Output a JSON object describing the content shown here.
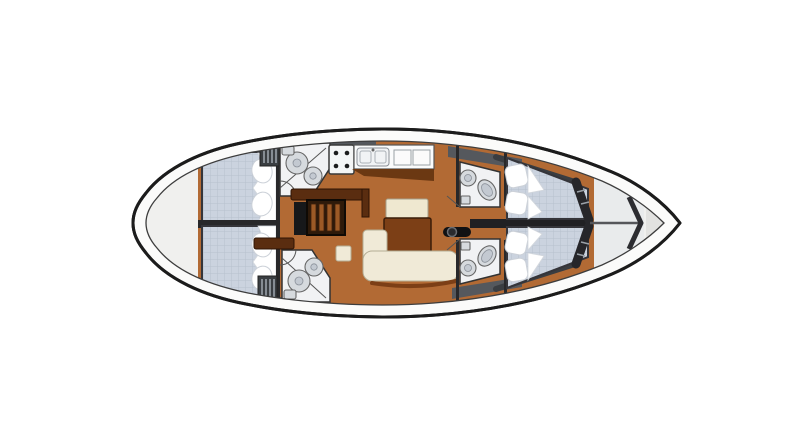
{
  "meta": {
    "type": "yacht-interior-deck-plan",
    "orientation": "bow-right",
    "visible_text": ""
  },
  "colors": {
    "page_bg": "#ffffff",
    "hull_fill": "#fbfbfa",
    "hull_outline": "#1c1c1c",
    "inner_deck": "#f0f0ee",
    "wood_floor": "#b26a34",
    "wood_dark_trim": "#6b3812",
    "furniture_dark_brown": "#5a2d10",
    "table_wood": "#7c3f16",
    "upholstery_cream": "#f0ead7",
    "mattress_blue": "#cbd3df",
    "mattress_line": "#b7c0ce",
    "pillow_white": "#ffffff",
    "head_floor": "#f1f2f4",
    "fixture_gray": "#d6dade",
    "bulkhead_dark": "#28282a",
    "deck_band_gray": "#55585d",
    "locker_light": "#e9ebec",
    "slat_light": "#9aa1a8",
    "stairs_wood": "#9c5a26",
    "stairs_frame": "#2e1a0a"
  },
  "components": [
    {
      "id": "hull"
    },
    {
      "id": "stern-deck"
    },
    {
      "id": "aft-cabin-port",
      "furniture": [
        "double-berth",
        "pillows"
      ]
    },
    {
      "id": "aft-cabin-starboard",
      "furniture": [
        "double-berth",
        "pillows"
      ]
    },
    {
      "id": "aft-head-port",
      "fixtures": [
        "shower",
        "sink"
      ]
    },
    {
      "id": "aft-head-starboard",
      "fixtures": [
        "shower",
        "sink"
      ]
    },
    {
      "id": "companionway-stairs"
    },
    {
      "id": "nav-furniture"
    },
    {
      "id": "galley",
      "fixtures": [
        "stove-4-burners",
        "double-sink",
        "counter-lockers"
      ]
    },
    {
      "id": "salon",
      "furniture": [
        "table",
        "table-leaf",
        "l-settee",
        "bench",
        "stool"
      ]
    },
    {
      "id": "mast-foot"
    },
    {
      "id": "fwd-head-port",
      "fixtures": [
        "toilet",
        "sink"
      ]
    },
    {
      "id": "fwd-head-starboard",
      "fixtures": [
        "toilet",
        "sink"
      ]
    },
    {
      "id": "fwd-cabin-port",
      "furniture": [
        "v-berth",
        "pillows"
      ]
    },
    {
      "id": "fwd-cabin-starboard",
      "furniture": [
        "v-berth",
        "pillows"
      ]
    },
    {
      "id": "bow-locker"
    },
    {
      "id": "bow-tip"
    }
  ]
}
